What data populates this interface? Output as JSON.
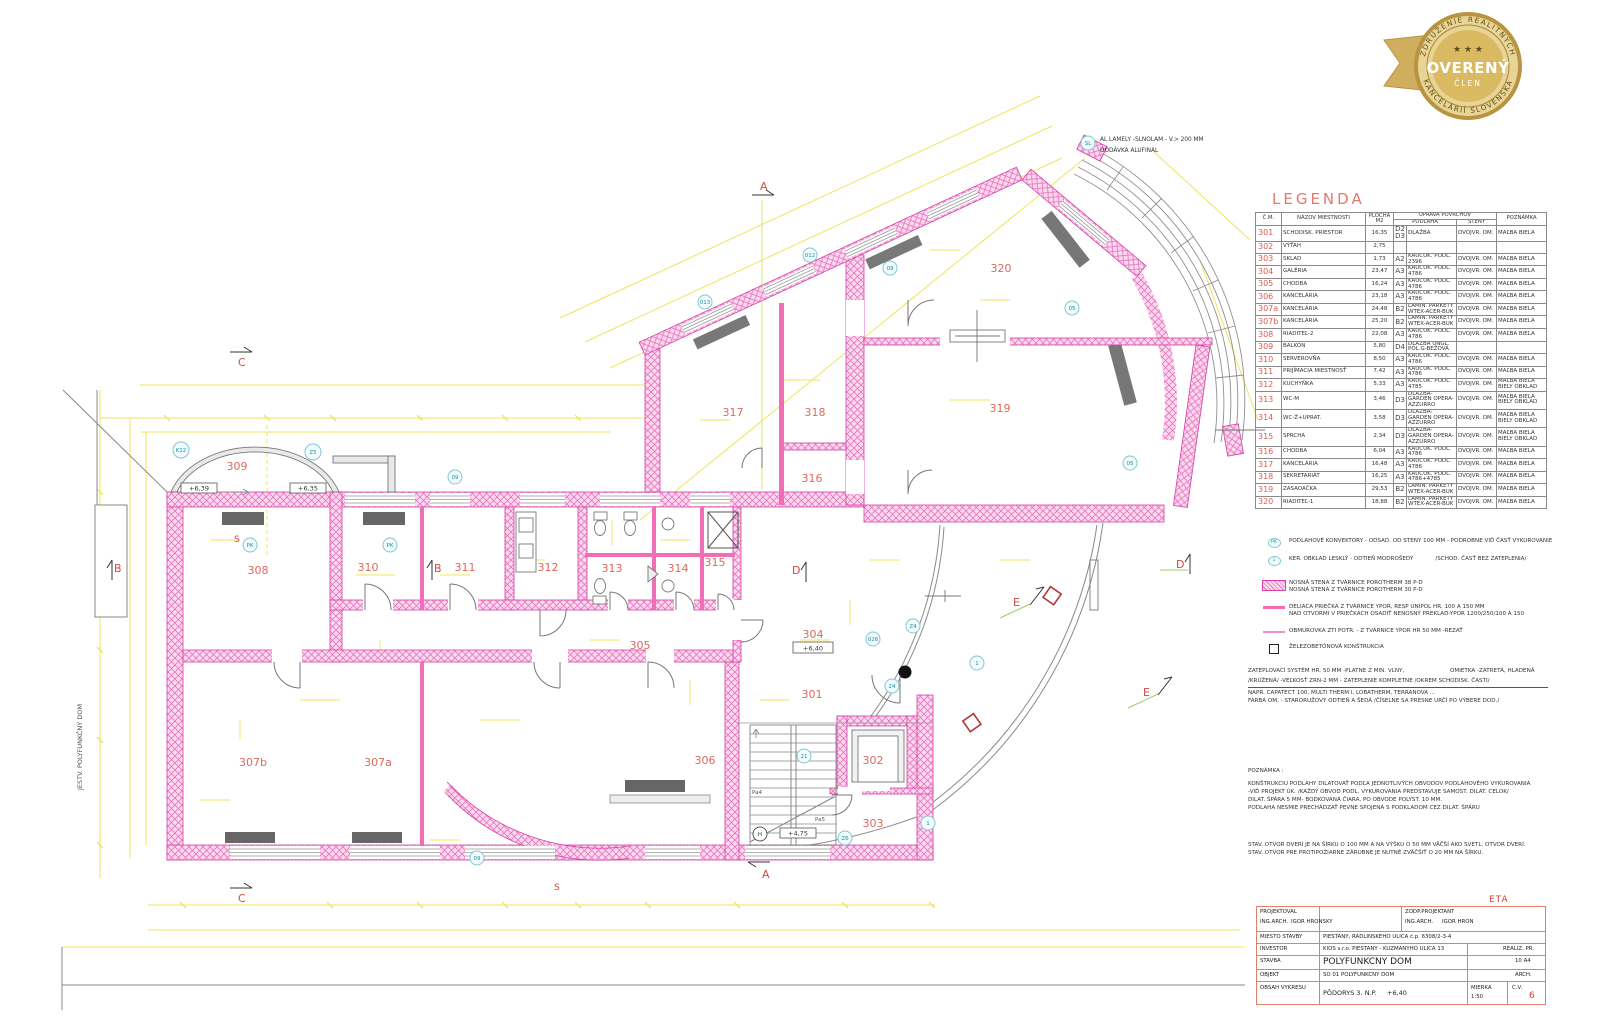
{
  "badge": {
    "arc_top": "ZDRUŽENIE REALITNÝCH",
    "arc_bottom": "KANCELÁRIÍ SLOVENSKA",
    "stars": "★ ★ ★",
    "title": "OVERENÝ",
    "subtitle": "ČLEN"
  },
  "legend": {
    "title": "LEGENDA",
    "headers": {
      "num": "Č.M.",
      "name": "NÁZOV MIESTNOSTI",
      "area": "PLOCHA M2",
      "surface": "ÚPRAVA POVRCHOV",
      "floor": "PODLAHA",
      "walls": "STENY",
      "note": "POZNÁMKA"
    },
    "rows": [
      {
        "num": "301",
        "name": "SCHODISK. PRIESTOR",
        "area": "16,35",
        "code": "D2 D3",
        "floor": "DLAŽBA",
        "walls": "DVOJVR. OM.",
        "note": "MAĽBA BIELA"
      },
      {
        "num": "302",
        "name": "VÝŤAH",
        "area": "2,75",
        "code": "",
        "floor": "",
        "walls": "",
        "note": ""
      },
      {
        "num": "303",
        "name": "SKLAD",
        "area": "1,73",
        "code": "A2",
        "floor": "KAUČUK. PODL. 2396",
        "walls": "DVOJVR. OM.",
        "note": "MAĽBA BIELA"
      },
      {
        "num": "304",
        "name": "GALÉRIA",
        "area": "23,47",
        "code": "A3",
        "floor": "KAUČUK. PODL. 4786",
        "walls": "DVOJVR. OM.",
        "note": "MAĽBA BIELA"
      },
      {
        "num": "305",
        "name": "CHODBA",
        "area": "16,24",
        "code": "A3",
        "floor": "KAUČUK. PODL. 4786",
        "walls": "DVOJVR. OM.",
        "note": "MAĽBA BIELA"
      },
      {
        "num": "306",
        "name": "KANCELÁRIA",
        "area": "23,18",
        "code": "A3",
        "floor": "KAUČUK. PODL. 4786",
        "walls": "DVOJVR. OM.",
        "note": "MAĽBA BIELA"
      },
      {
        "num": "307a",
        "name": "KANCELÁRIA",
        "area": "24,48",
        "code": "B2",
        "floor": "LAMIN. PARKETY WTEX-ACER-BUK",
        "walls": "DVOJVR. OM.",
        "note": "MAĽBA BIELA"
      },
      {
        "num": "307b",
        "name": "KANCELÁRIA",
        "area": "25,20",
        "code": "B2",
        "floor": "LAMIN. PARKETY WTEX-ACER-BUK",
        "walls": "DVOJVR. OM.",
        "note": "MAĽBA BIELA"
      },
      {
        "num": "308",
        "name": "RIADITEĽ-2",
        "area": "22,08",
        "code": "A3",
        "floor": "KAUČUK. PODL. 4786",
        "walls": "DVOJVR. OM.",
        "note": "MAĽBA BIELA"
      },
      {
        "num": "309",
        "name": "BALKÓN",
        "area": "5,80",
        "code": "D4",
        "floor": "DLAŽBA UNGL. POL.G-BEŽOVÁ",
        "walls": "",
        "note": ""
      },
      {
        "num": "310",
        "name": "SERVEROVŇA",
        "area": "8,50",
        "code": "A3",
        "floor": "KAUČUK. PODL. 4786",
        "walls": "DVOJVR. OM.",
        "note": "MAĽBA BIELA"
      },
      {
        "num": "311",
        "name": "PRIJÍMACIA MIESTNOSŤ",
        "area": "7,42",
        "code": "A3",
        "floor": "KAUČUK. PODL. 4786",
        "walls": "DVOJVR. OM.",
        "note": "MAĽBA BIELA"
      },
      {
        "num": "312",
        "name": "KUCHYŇKA",
        "area": "5,33",
        "code": "A3",
        "floor": "KAUČUK. PODL. 4785",
        "walls": "DVOJVR. OM.",
        "note": "MAĽBA BIELA BIELY OBKLAD"
      },
      {
        "num": "313",
        "name": "WC-M",
        "area": "3,46",
        "code": "D3",
        "floor": "DLAŽBA-GARDEN OPERA-AZZURRO",
        "walls": "DVOJVR. OM.",
        "note": "MAĽBA BIELA BIELY OBKLAD"
      },
      {
        "num": "314",
        "name": "WC-Ž+UPRAT.",
        "area": "3,58",
        "code": "D3",
        "floor": "DLAŽBA-GARDEN OPERA-AZZURRO",
        "walls": "DVOJVR. OM.",
        "note": "MAĽBA BIELA BIELY OBKLAD"
      },
      {
        "num": "315",
        "name": "SPRCHA",
        "area": "2,34",
        "code": "D3",
        "floor": "DLAŽBA-GARDEN OPERA-AZZURRO",
        "walls": "DVOJVR. OM.",
        "note": "MAĽBA BIELA BIELY OBKLAD"
      },
      {
        "num": "316",
        "name": "CHODBA",
        "area": "6,04",
        "code": "A3",
        "floor": "KAUČUK. PODL. 4786",
        "walls": "DVOJVR. OM.",
        "note": "MAĽBA BIELA"
      },
      {
        "num": "317",
        "name": "KANCELÁRIA",
        "area": "16,48",
        "code": "A3",
        "floor": "KAUČUK. PODL. 4786",
        "walls": "DVOJVR. OM.",
        "note": "MAĽBA BIELA"
      },
      {
        "num": "318",
        "name": "SEKRETARIÁT",
        "area": "16,25",
        "code": "A3",
        "floor": "KAUČUK. PODL. 4786+4785",
        "walls": "DVOJVR. OM.",
        "note": "MAĽBA BIELA"
      },
      {
        "num": "319",
        "name": "ZASADAČKA",
        "area": "29,53",
        "code": "B2",
        "floor": "LAMIN. PARKETY WTEX-ACER-BUK",
        "walls": "DVOJVR. OM.",
        "note": "MAĽBA BIELA"
      },
      {
        "num": "320",
        "name": "RIADITEĽ-1",
        "area": "18,88",
        "code": "B2",
        "floor": "LAMIN. PARKETY WTEX-ACER-BUK",
        "walls": "DVOJVR. OM.",
        "note": "MAĽBA BIELA"
      }
    ],
    "symbols": [
      {
        "key": "PK",
        "text": "PODLAHOVÉ KONVEKTORY - ODSAD. OD STENY 100 MM - PODROBNE VIĎ ČASŤ VYKUROVANIE",
        "text2": ""
      },
      {
        "key": "1",
        "text": "KER. OBKLAD LESKLÝ - ODTIEŇ MODROŠEDÝ",
        "text2": "/SCHOD. ČASŤ BEZ ZATEPLENIA/"
      },
      {
        "key": "hatch",
        "text": "NOSNÁ STENA Z   TVÁRNICE POROTHERM 38 P-D",
        "text2": "NOSNÁ STENA Z   TVÁRNICE POROTHERM 30 P-D"
      },
      {
        "key": "partition",
        "text": "DELIACA PRIEČKA Z TVÁRNICE YPOR, RESP UNIPOL HR. 100 A 150 MM",
        "text2": "NAD OTVORMI V PRIEČKACH OSADIŤ NENOSNÝ PREKLAD-YPOR 1200/250/100 A 150"
      },
      {
        "key": "thinline",
        "text": "OBMUROVKA ZTI POTR. - Z TVÁRNICE YPOR HR 50 MM -REZAŤ",
        "text2": ""
      },
      {
        "key": "square",
        "text": "ŽELEZOBETÓNOVÁ KONŠTRUKCIA",
        "text2": ""
      }
    ]
  },
  "notes": {
    "ins1_left": "ZATEPLOVACÍ SYSTÉM HR. 50 MM -PLATNE Z MIN. VLNY,",
    "ins1_right": "OMIETKA -ZATRETÁ, HLADENÁ",
    "ins2": "/KRÚŽENÁ/ -VEĽKOSŤ ZRN-2 MM - ZATEPLENIE KOMPLETNE /OKREM SCHODISK. ČASTI/",
    "ins3": "NAPR. CAPATECT 100, MULTI THERM I, LOBATHERM, TERRANOVA ...",
    "ins4": "FARBA OM. - STARORUŽOVÝ ODTIEŇ A ŠEDÁ /ČÍSELNE SA PRESNE URČÍ PO VÝBERE DOD./",
    "poznamka_title": "POZNÁMKA :",
    "poznamka": [
      "KONŠTRUKCIU PODLAHY DILATOVAŤ PODĽA JEDNOTLIVÝCH OBVODOV PODLAHOVÉHO VYKUROVANIA",
      "-VIĎ PROJEKT ÚK. /KAŽDÝ OBVOD PODL. VYKUROVANIA PREDSTAVUJE SAMOST. DILAT. CELOK/",
      "DILAT. ŠPÁRA 5 MM- BODKOVANÁ ČIARA, PO OBVODE POLYST. 10 MM.",
      "PODLAHA NESMIE PRECHÁDZAŤ PEVNE SPOJENÁ S PODKLADOM CEZ DILAT. ŠPÁRU"
    ],
    "stav": [
      "STAV. OTVOR DVERÍ JE NA ŠÍRKU O 100 MM A NA VÝŠKU O 50 MM VÄČŠÍ AKO SVETL. OTVOR DVERÍ.",
      "STAV. OTVOR PRE PROTIPOŽIARNE ZÁRUBNE JE NUTNÉ ZVÄČŠIŤ O 20 MM NA ŠÍRKU."
    ]
  },
  "titleblock": {
    "projektoval_label": "PROJEKTOVAL",
    "projektoval_role": "ING.ARCH.",
    "projektoval_name": "IGOR HRONSKÝ",
    "zodp_label": "ZODP.PROJEKTANT",
    "zodp_role": "ING.ARCH.",
    "zodp_name": "IGOR HRON",
    "miesto_label": "MIESTO STAVBY",
    "miesto": "PIEŠŤANY, RADLINSKÉHO ULICA č.p. 6308/2-3-4",
    "investor_label": "INVESTOR",
    "investor": "KIOS s.r.o. PIEŠŤANY - KUZMÁNYHO ULICA 13",
    "stavba_label": "STAVBA",
    "stavba": "POLYFUNKČNÝ DOM",
    "objekt_label": "OBJEKT",
    "objekt": "SO 01 POLYFUNKČNÝ DOM",
    "obsah_label": "OBSAH VÝKRESU",
    "obsah": "PÔDORYS 3. N.P.",
    "level": "+6,40",
    "mierka_label": "MIERKA",
    "mierka": "1:50",
    "cv_label": "Č.V.",
    "cv": "6",
    "realiz": "REALIZ. PR.",
    "format": "10 A4",
    "arch": "ARCH.",
    "etapa": "ETA"
  },
  "plan": {
    "rooms": [
      "309",
      "308",
      "310",
      "311",
      "312",
      "313",
      "314",
      "315",
      "305",
      "304",
      "301",
      "306",
      "302",
      "303",
      "307b",
      "307a",
      "316",
      "317",
      "318",
      "319",
      "320"
    ],
    "levels": [
      "+6,39",
      "+6,35",
      "+6,40",
      "+4,75"
    ],
    "sections": [
      "A",
      "B",
      "C",
      "D",
      "E",
      "S"
    ],
    "markers": [
      "K12",
      "Z5",
      "SL",
      "09",
      "012",
      "013",
      "05",
      "PK",
      "H",
      "Z6",
      "Z4",
      "1",
      "21",
      "24",
      "026",
      "Pa4",
      "Pa5"
    ],
    "side_label": "JESTV. POLYFUNKČNÝ DOM",
    "lamely_note_1": "AL LAMELY -SLNOLAM - V.> 200 MM",
    "lamely_note_2": "DODÁVKA ALUFINAL"
  }
}
